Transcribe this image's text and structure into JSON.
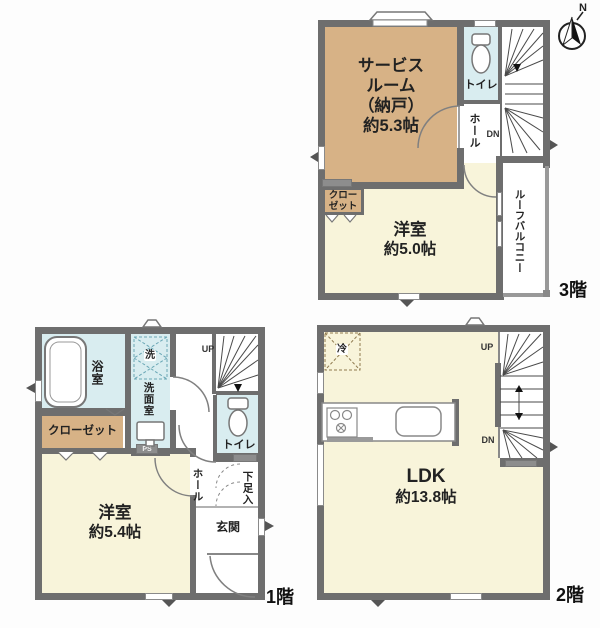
{
  "compass": {
    "north_label": "N"
  },
  "floor3": {
    "floor_label": "3階",
    "service_room_lines": [
      "サービス",
      "ルーム",
      "（納戸）",
      "約5.3帖"
    ],
    "toilet_label": "トイレ",
    "hall_label": "ホール",
    "dn_label": "DN",
    "closet_lines": [
      "クロー",
      "ゼット"
    ],
    "western_room_name": "洋室",
    "western_room_size": "約5.0帖",
    "roof_balcony_label": "ルーフバルコニー"
  },
  "floor2": {
    "floor_label": "2階",
    "fridge_label": "冷",
    "up_label": "UP",
    "dn_label": "DN",
    "ldk_name": "LDK",
    "ldk_size": "約13.8帖"
  },
  "floor1": {
    "floor_label": "1階",
    "bathroom_label": "浴室",
    "washer_label": "洗",
    "washroom_label": "洗面室",
    "up_label": "UP",
    "toilet_label": "トイレ",
    "ps_label": "PS",
    "closet_label": "クローゼット",
    "western_room_name": "洋室",
    "western_room_size": "約5.4帖",
    "hall_label": "ホール",
    "shoe_cabinet_label": "下足入",
    "entrance_label": "玄関"
  },
  "colors": {
    "wall": "#6e6e6e",
    "room_tan": "#d7b286",
    "room_cream": "#f8f4da",
    "room_blue": "#d9edf0"
  }
}
